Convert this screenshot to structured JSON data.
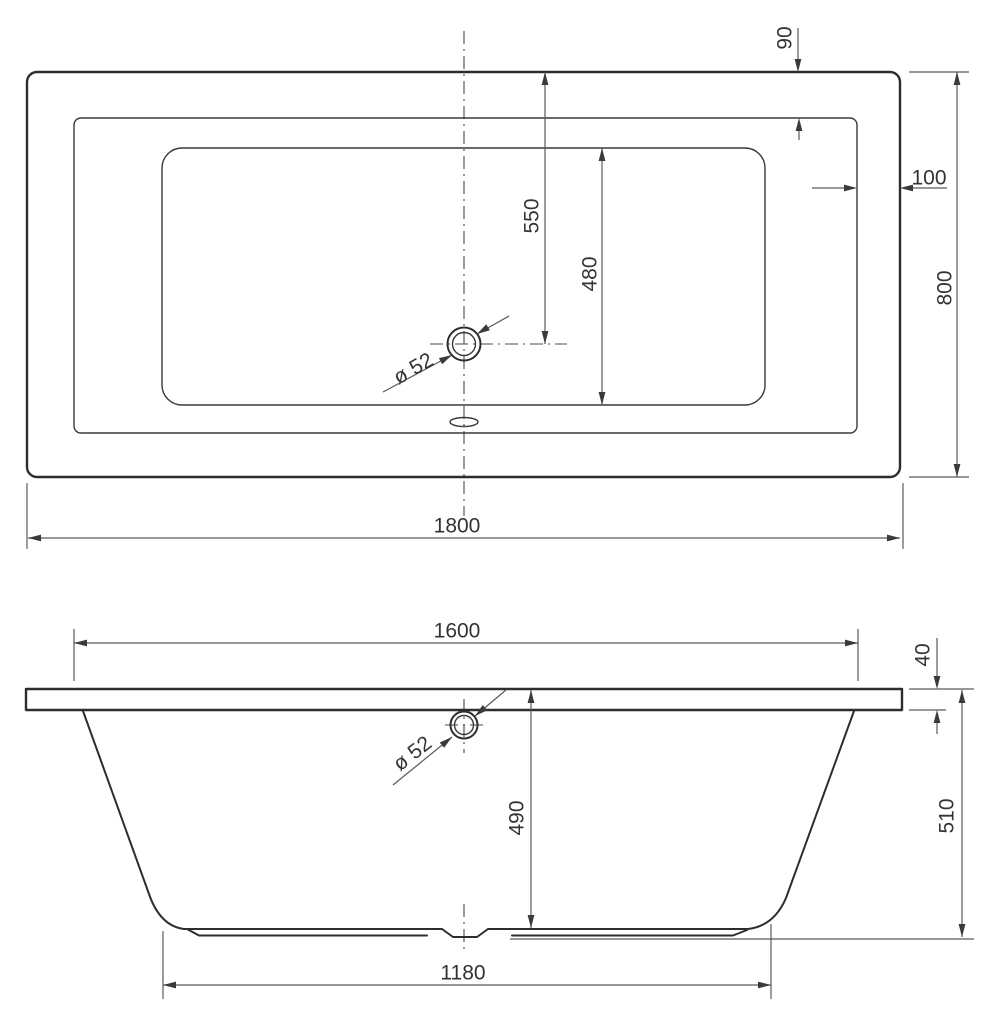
{
  "drawing": {
    "title": "Bathtub technical drawing, two orthographic views",
    "colors": {
      "background": "#ffffff",
      "outline": "#2d2d2d",
      "dimension_lines": "#5a5a5a",
      "text": "#333333"
    }
  },
  "dimensions": {
    "top_view": {
      "rim_width_top": "90",
      "rim_width_right": "100",
      "overall_width": "800",
      "drain_center_from_edge": "550",
      "inner_basin_width": "480",
      "drain_diameter": "ø 52",
      "overall_length": "1800"
    },
    "side_view": {
      "inner_rim_length": "1600",
      "rim_thickness": "40",
      "overall_height": "510",
      "inner_depth": "490",
      "drain_diameter": "ø 52",
      "base_length": "1180"
    }
  }
}
